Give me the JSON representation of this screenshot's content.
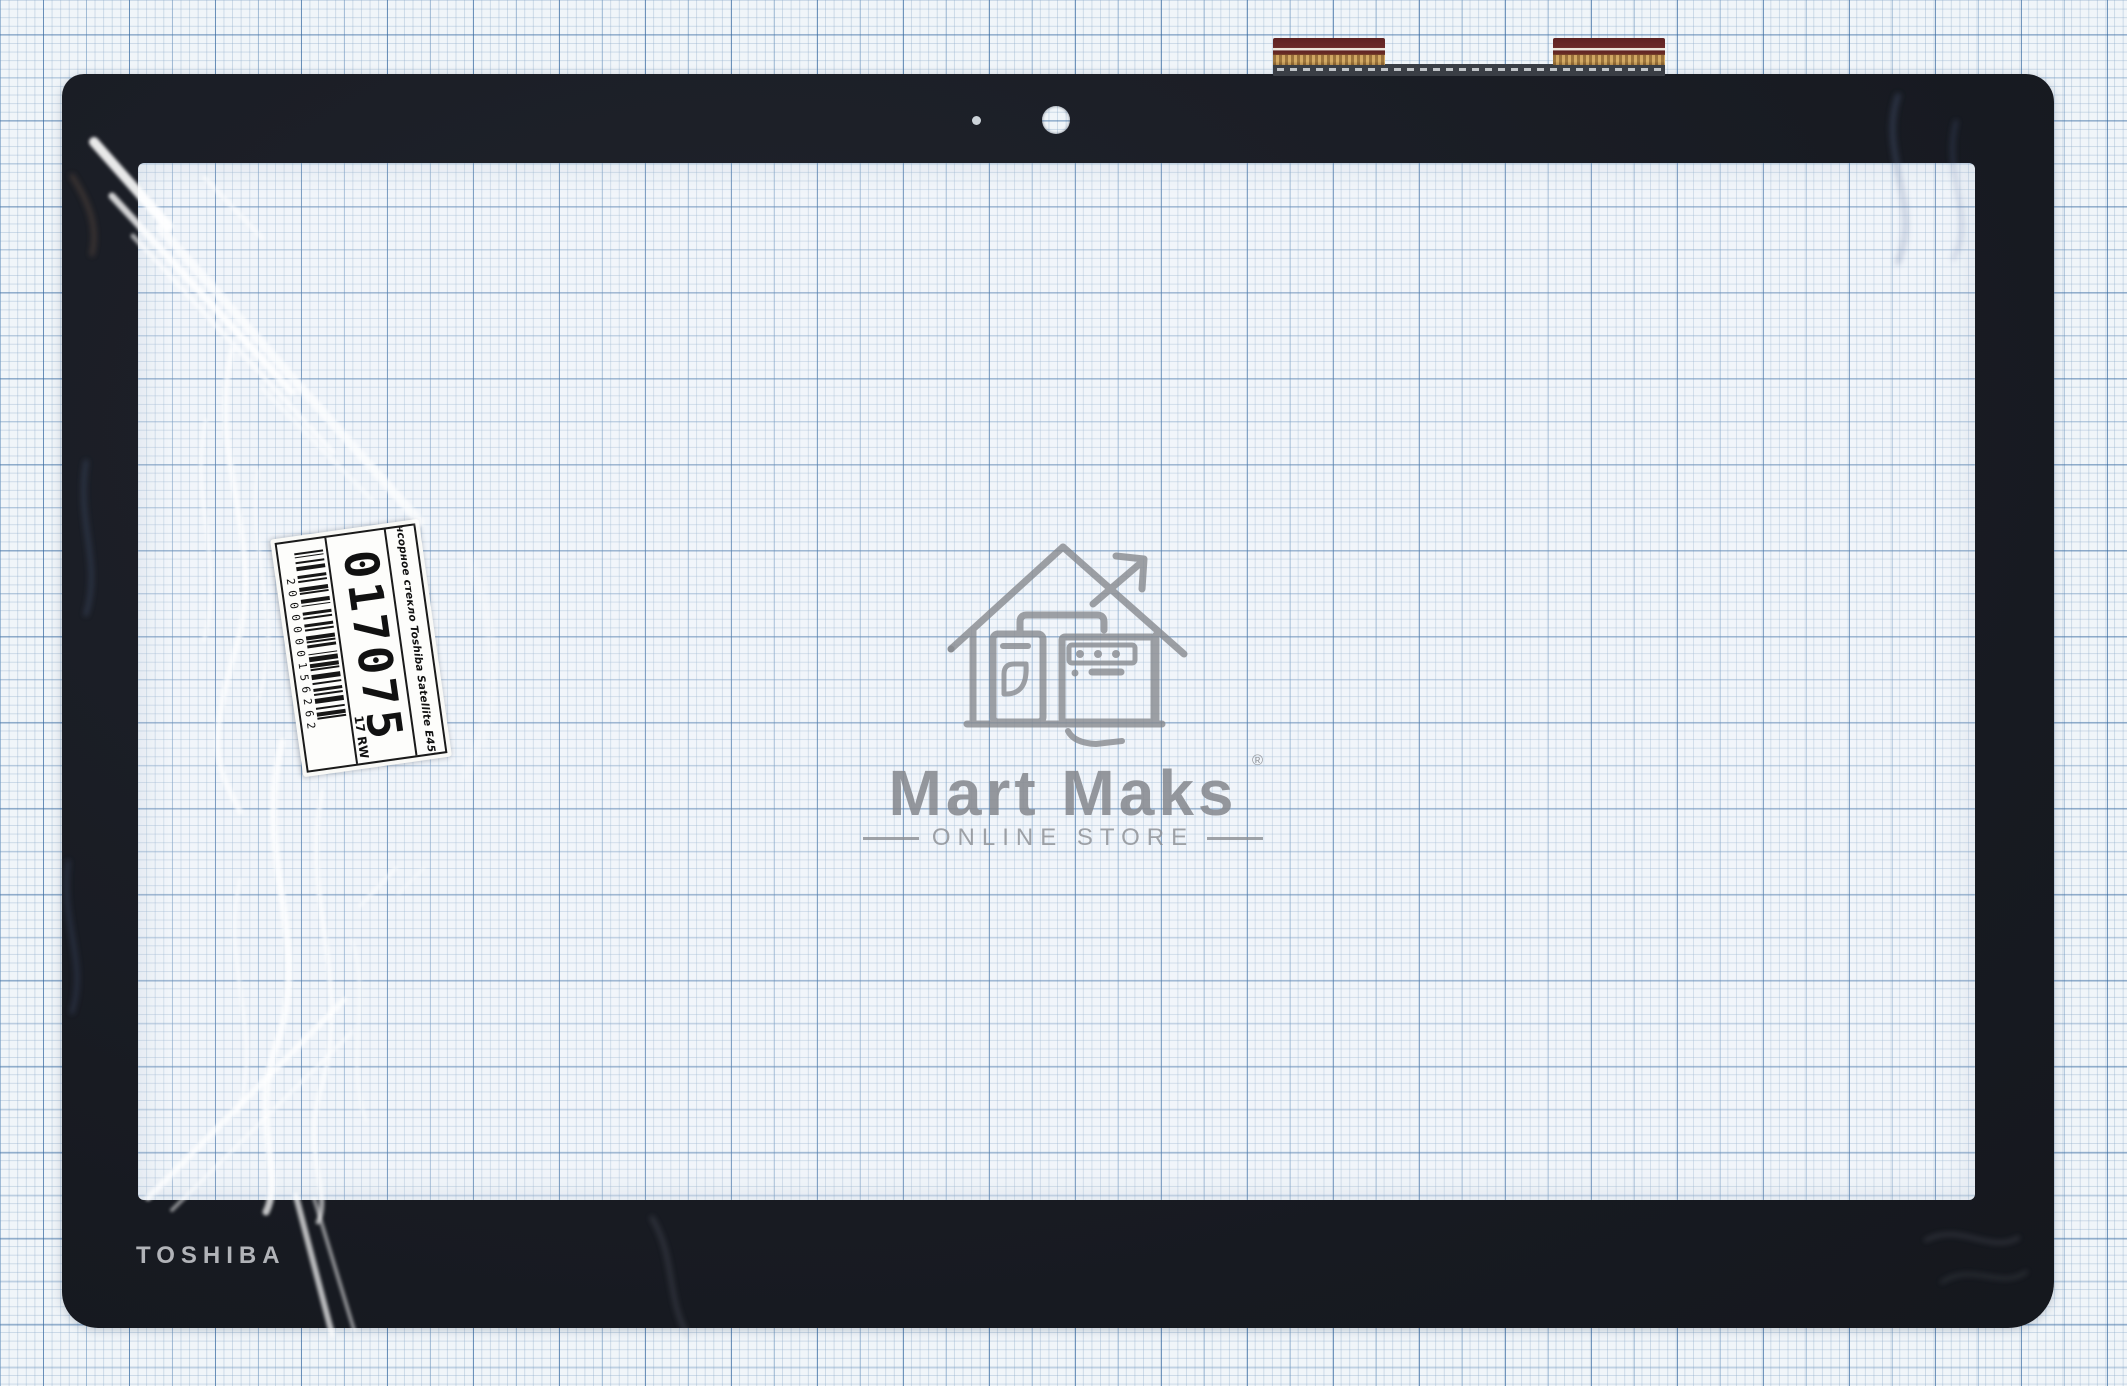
{
  "photo": {
    "subject": "touchscreen digitizer glass with black bezel on millimeter graph paper",
    "background": "blue millimeter grid paper"
  },
  "bezel": {
    "brand_label": "TOSHIBA",
    "color": "#171a21",
    "logo_color": "#b1b3b8"
  },
  "sticker": {
    "title": "Сенсорное стекло Toshiba Satellite E45T-B",
    "sku": "017075",
    "size_code": "17 RW",
    "barcode_digits": "2000000156262"
  },
  "watermark": {
    "brand": "Mart Maks",
    "registered": "®",
    "subtitle": "ONLINE STORE",
    "color": "#84878c",
    "icon": "house-with-arrow-and-appliances"
  },
  "ribbons": {
    "count": 2,
    "film_color": "#5e2222",
    "stripe_color": "#ece7dc",
    "contact_color": "#c19455",
    "stiffener_color": "#3a3e45"
  },
  "grid_colors": {
    "paper": "#f0f5f9",
    "fine_line": "#8eacca",
    "medium_line": "#608cb9",
    "major_line": "#2f629b"
  }
}
